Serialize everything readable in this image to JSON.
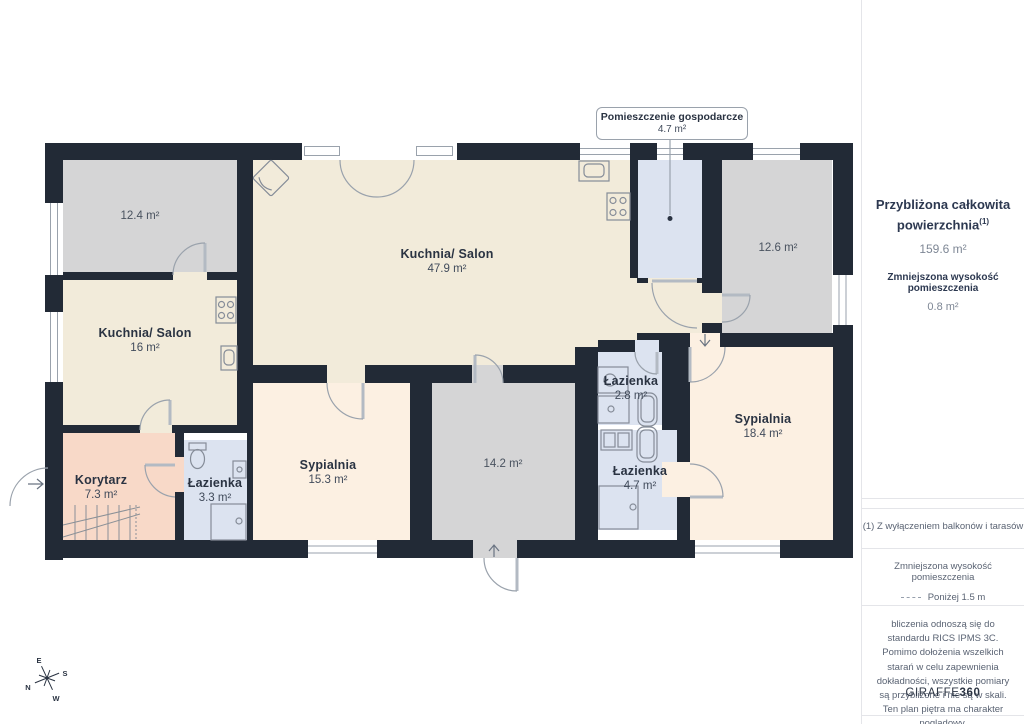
{
  "plan": {
    "callout": {
      "title": "Pomieszczenie gospodarcze",
      "area": "4.7 m²"
    },
    "rooms": [
      {
        "name": "",
        "area": "12.4 m²"
      },
      {
        "name": "Kuchnia/ Salon",
        "area": "16 m²"
      },
      {
        "name": "Kuchnia/ Salon",
        "area": "47.9 m²"
      },
      {
        "name": "Korytarz",
        "area": "7.3 m²"
      },
      {
        "name": "Łazienka",
        "area": "3.3 m²"
      },
      {
        "name": "Sypialnia",
        "area": "15.3 m²"
      },
      {
        "name": "",
        "area": "14.2 m²"
      },
      {
        "name": "Łazienka",
        "area": "2.8 m²"
      },
      {
        "name": "Łazienka",
        "area": "4.7 m²"
      },
      {
        "name": "Sypialnia",
        "area": "18.4 m²"
      },
      {
        "name": "",
        "area": "12.6 m²"
      }
    ],
    "compass": {
      "n": "N",
      "s": "S",
      "e": "E",
      "w": "W"
    }
  },
  "sidebar": {
    "total_label": "Przybliżona całkowita powierzchnia",
    "total_sup": "(1)",
    "total_value": "159.6 m²",
    "reduced_label": "Zmniejszona wysokość pomieszczenia",
    "reduced_value": "0.8 m²",
    "footnote": "(1) Z wyłączeniem balkonów i tarasów",
    "legend_title": "Zmniejszona wysokość pomieszczenia",
    "legend_value": "Poniżej 1.5 m",
    "disclaimer": "bliczenia odnoszą się do standardu RICS IPMS 3C. Pomimo dołożenia wszelkich starań w celu zapewnienia dokładności, wszystkie pomiary są przybliżone i nie są w skali. Ten plan piętra ma charakter poglądowy.",
    "brand_normal": "GIRAFFE",
    "brand_bold": "360"
  },
  "colors": {
    "wall": "#222a36",
    "cream": "#f2ebda",
    "peach": "#fcf0e2",
    "salmon": "#f8d9c8",
    "gray-room": "#d5d5d6",
    "blue-room": "#dce3f0",
    "ink": "#2a3342",
    "muted": "#7e8795",
    "small": "#5a6373",
    "border": "#e4e5e9",
    "line": "#9aa2ac",
    "fixture": "#858c98"
  }
}
